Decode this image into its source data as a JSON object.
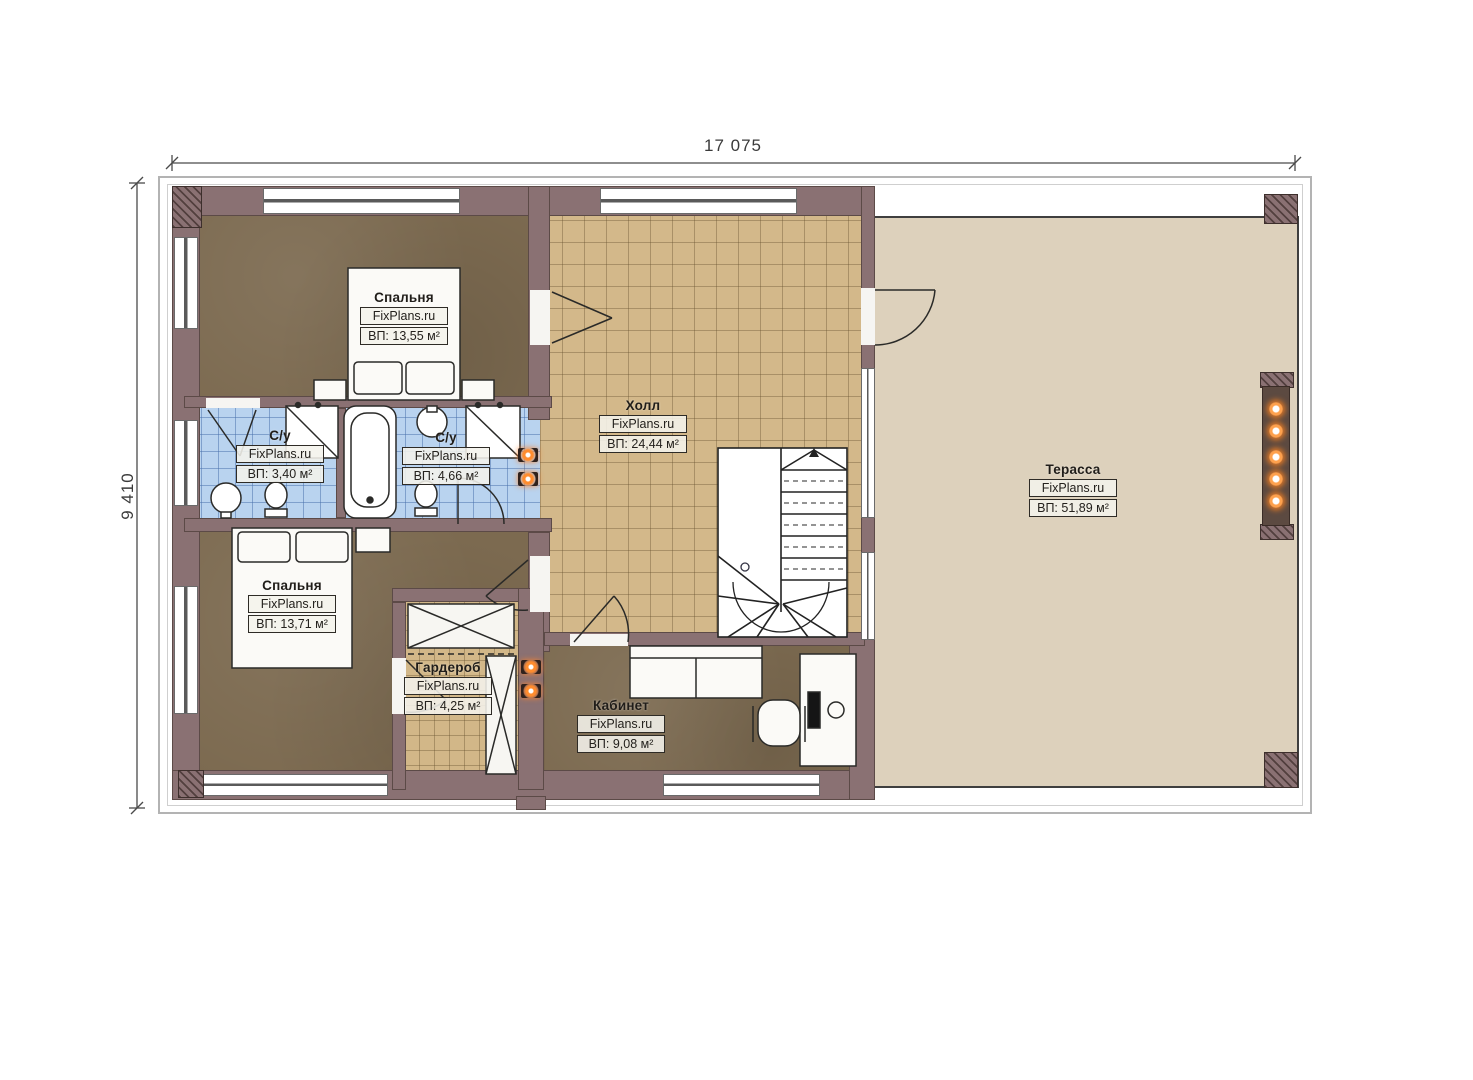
{
  "dimensions": {
    "width": "17 075",
    "height": "9 410"
  },
  "branding": "FixPlans.ru",
  "rooms": [
    {
      "id": "bedroom-1",
      "name": "Спальня",
      "area": "ВП: 13,55 м²"
    },
    {
      "id": "bathroom-1",
      "name": "С/у",
      "area": "ВП: 3,40 м²"
    },
    {
      "id": "bathroom-2",
      "name": "С/у",
      "area": "ВП: 4,66 м²"
    },
    {
      "id": "hall",
      "name": "Холл",
      "area": "ВП: 24,44 м²"
    },
    {
      "id": "terrace",
      "name": "Терасса",
      "area": "ВП: 51,89 м²"
    },
    {
      "id": "bedroom-2",
      "name": "Спальня",
      "area": "ВП: 13,71 м²"
    },
    {
      "id": "wardrobe",
      "name": "Гардероб",
      "area": "ВП: 4,25 м²"
    },
    {
      "id": "office",
      "name": "Кабинет",
      "area": "ВП: 9,08 м²"
    }
  ],
  "colors": {
    "wall": "#8a7173",
    "bedroom_floor": "#7c6a50",
    "tile_floor": "#d3b88a",
    "bathroom_floor": "#b9d3ef",
    "terrace_floor": "#ddd1bc",
    "accent_light": "#ff8c2e"
  }
}
